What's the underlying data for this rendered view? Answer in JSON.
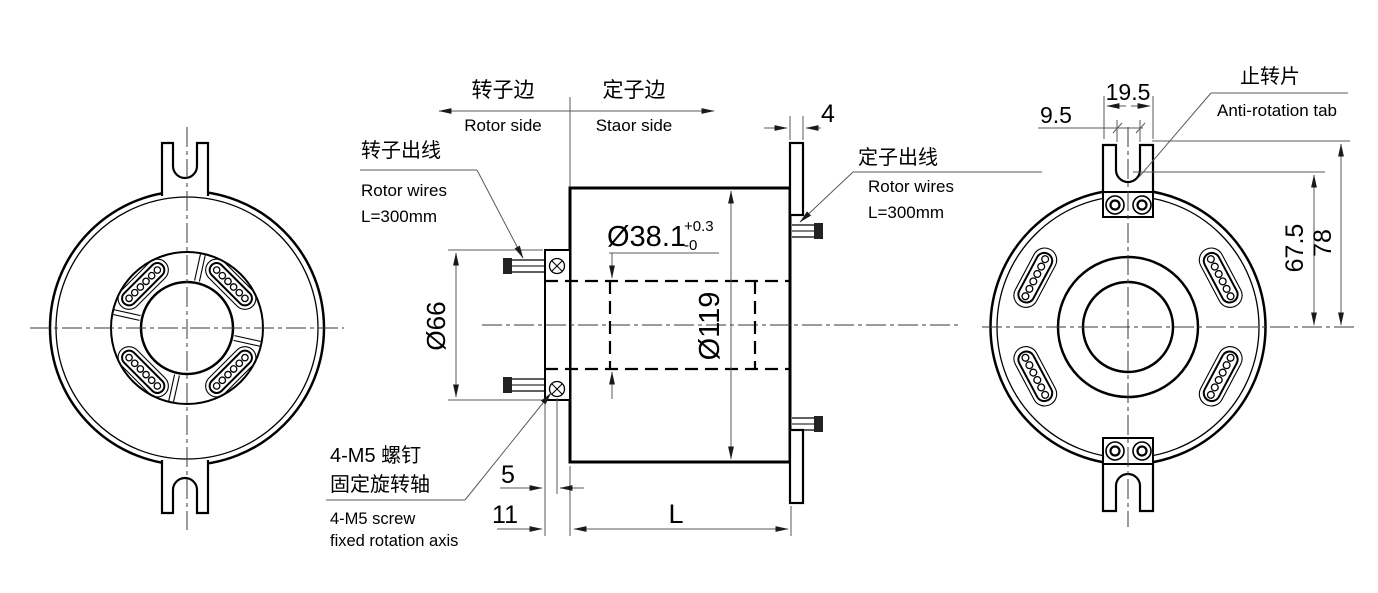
{
  "annotations": {
    "side_split": {
      "left_cn": "转子边",
      "left_en": "Rotor side",
      "right_cn": "定子边",
      "right_en": "Staor side"
    },
    "rotor_wires": {
      "cn": "转子出线",
      "en": "Rotor wires",
      "length": "L=300mm"
    },
    "stator_wires": {
      "cn": "定子出线",
      "en": "Rotor wires",
      "length": "L=300mm"
    },
    "screw_note": {
      "cn_line1": "4-M5 螺钉",
      "cn_line2": "固定旋转轴",
      "en_line1": "4-M5 screw",
      "en_line2": "fixed rotation axis"
    },
    "anti_rotation_tab": {
      "cn": "止转片",
      "en": "Anti-rotation tab"
    }
  },
  "dimensions": {
    "bore_diameter": "Ø38.1",
    "bore_tolerance_plus": "+0.3",
    "bore_tolerance_minus": "-0",
    "rotor_plate_diameter": "Ø66",
    "body_diameter": "Ø119",
    "flange_thickness": "4",
    "screw_to_face": "5",
    "plate_width": "11",
    "body_length": "L",
    "slot_width": "9.5",
    "tab_width": "19.5",
    "slot_bottom_to_center": "67.5",
    "tab_top_to_center": "78"
  },
  "colors": {
    "line": "#000000",
    "dimension": "#595959",
    "background": "#ffffff"
  }
}
